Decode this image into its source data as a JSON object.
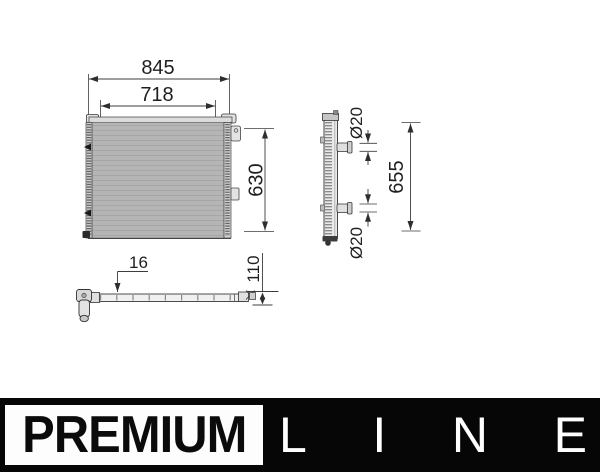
{
  "dims": {
    "overall_width": "845",
    "core_width": "718",
    "core_height": "630",
    "overall_height": "655",
    "port_top": "Ø20",
    "port_bottom": "Ø20",
    "core_depth": "16",
    "overall_depth": "110"
  },
  "logo": {
    "premium": "PREMIUM",
    "line": [
      "L",
      "I",
      "N",
      "E"
    ]
  },
  "colors": {
    "drawing_line": "#333333",
    "core_fill": "#b5b5b5",
    "logo_bar": "#060606",
    "logo_premium_bg": "#fdfdfd",
    "logo_premium_text": "#0b0b0b",
    "logo_line_text": "#ffffff"
  }
}
